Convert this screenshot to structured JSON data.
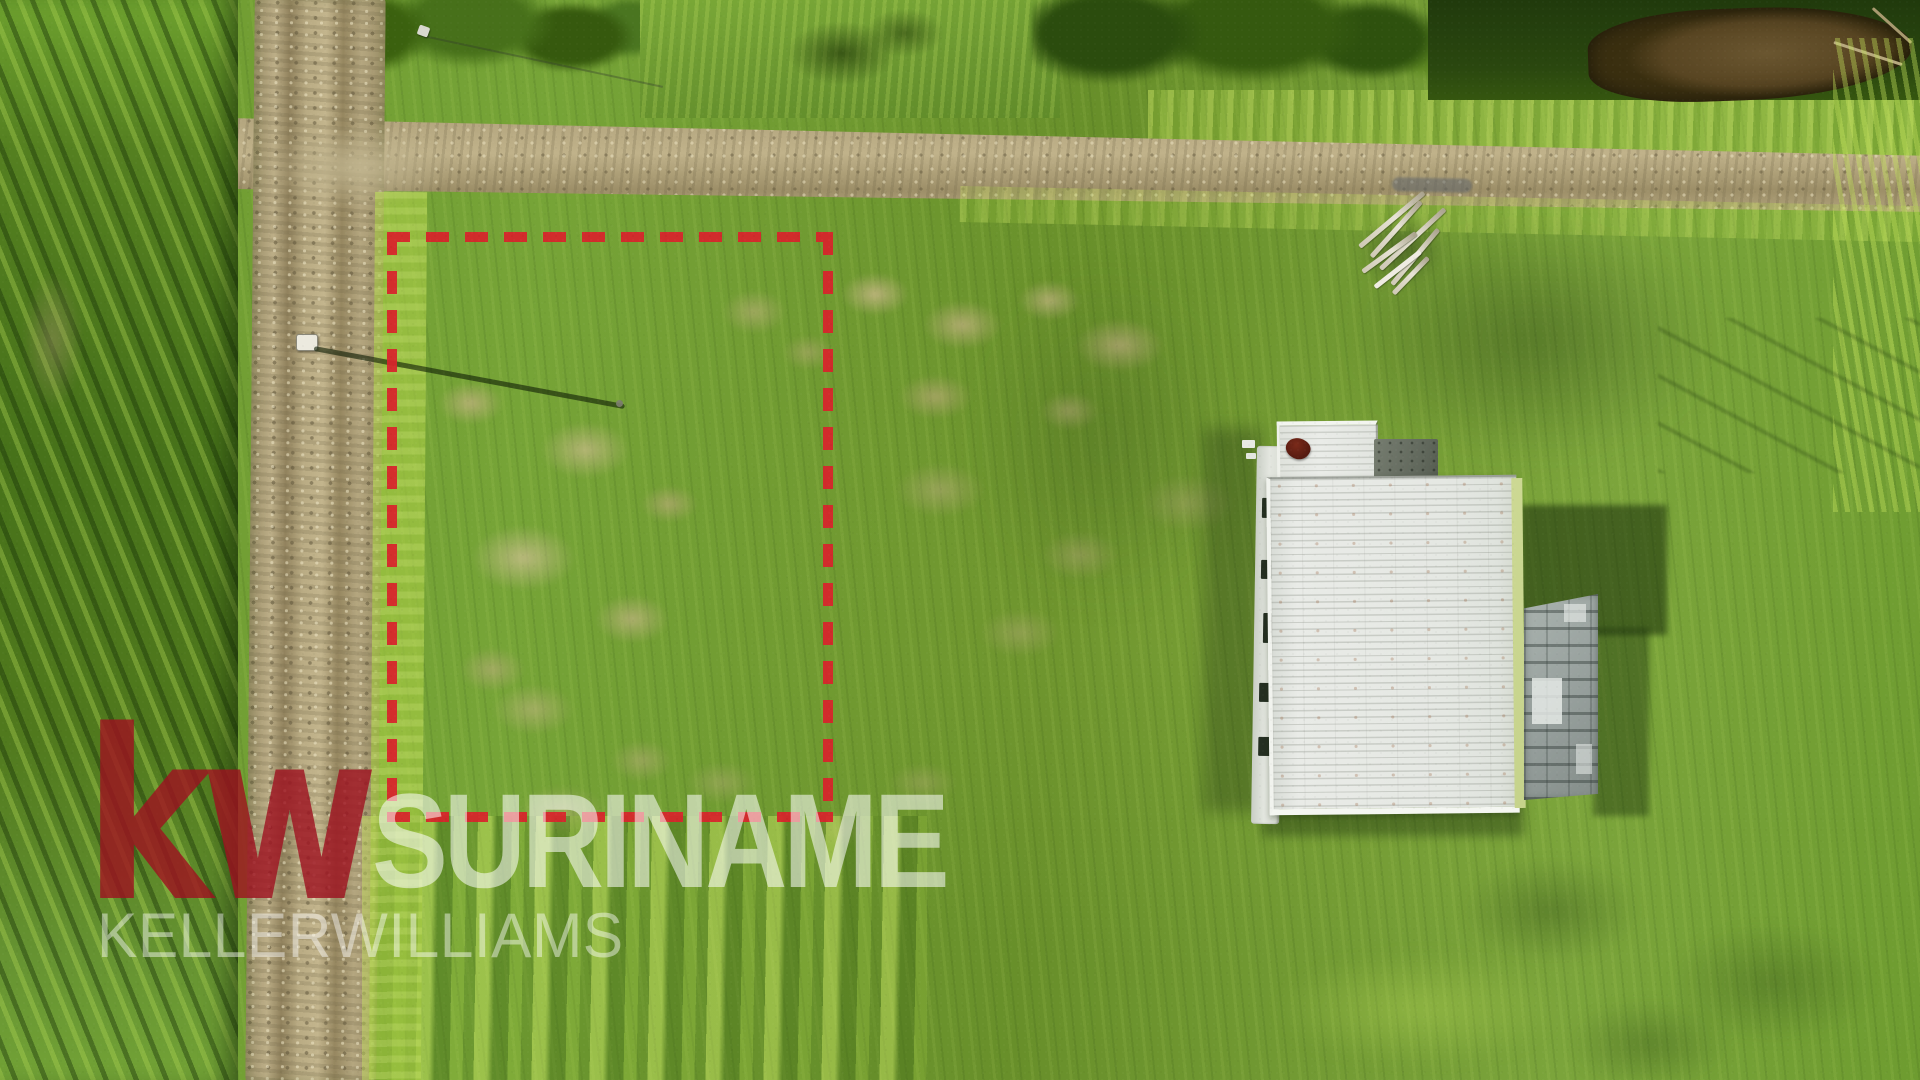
{
  "watermark": {
    "logo_text": "kw",
    "region_name": "SURINAME",
    "company_name": "KELLERWILLIAMS"
  },
  "boundary": {
    "style": "dashed",
    "shape": "rectangle"
  },
  "colors": {
    "boundary_red": "#d8232b",
    "kw_logo_red": "#9f1120",
    "watermark_white": "#ffffff",
    "grass_base_green": "#6f9a30",
    "grass_dark_green": "#47721a",
    "grass_lime": "#a9cc45",
    "dry_grass_tan": "#c6b488",
    "road_tan": "#b3a57e",
    "roof_white": "#e7e9e5",
    "annex_gray": "#99a29e",
    "pond_brown": "#5e4b24"
  }
}
